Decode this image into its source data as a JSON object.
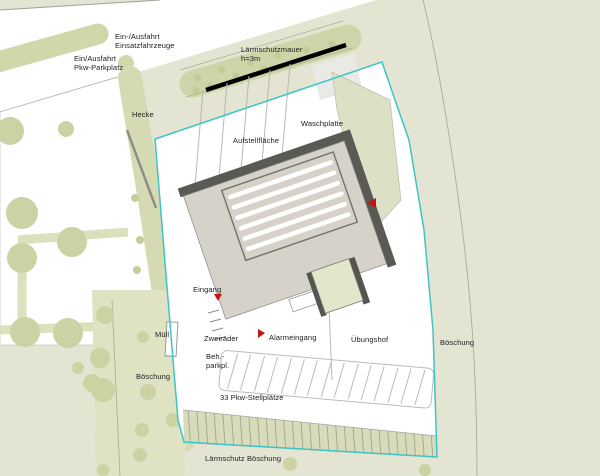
{
  "plan": {
    "type": "site-plan",
    "language": "de"
  },
  "labels": [
    {
      "id": "entrance-emergency",
      "text": "Ein-/Ausfahrt\nEinsatzfahrzeuge"
    },
    {
      "id": "entrance-car-park",
      "text": "Ein/Ausfahrt\nPkw-Parkplatz"
    },
    {
      "id": "noise-wall",
      "text": "Lärmschutzmauer\nh=3m"
    },
    {
      "id": "hedge",
      "text": "Hecke"
    },
    {
      "id": "staging-area",
      "text": "Aufstellfläche"
    },
    {
      "id": "wash-pad",
      "text": "Waschplatte"
    },
    {
      "id": "entrance",
      "text": "Eingang"
    },
    {
      "id": "waste",
      "text": "Müll"
    },
    {
      "id": "two-wheelers",
      "text": "Zweiräder"
    },
    {
      "id": "alarm-entrance",
      "text": "Alarmeingang"
    },
    {
      "id": "drill-yard",
      "text": "Übungshof"
    },
    {
      "id": "disabled-parking",
      "text": "Beh.-\nparkpl."
    },
    {
      "id": "embankment-left",
      "text": "Böschung"
    },
    {
      "id": "car-spaces",
      "text": "33 Pkw-Stellplätze"
    },
    {
      "id": "embankment-right",
      "text": "Böschung"
    },
    {
      "id": "noise-embankment",
      "text": "Lärmschutz Böschung"
    }
  ],
  "colors": {
    "background": "#e3e5d2",
    "site_boundary": "#3bc5c7",
    "noise_wall": "#000000",
    "building_fill": "#d6d2ca",
    "building_edge": "#5a5a55",
    "tower_fill": "#e2e6ca",
    "greenery": "#cfd5a8",
    "marker_red": "#c41414"
  },
  "markers": [
    {
      "id": "building-right-entry-arrow"
    },
    {
      "id": "eingang-arrow"
    },
    {
      "id": "alarmeingang-arrow"
    }
  ]
}
